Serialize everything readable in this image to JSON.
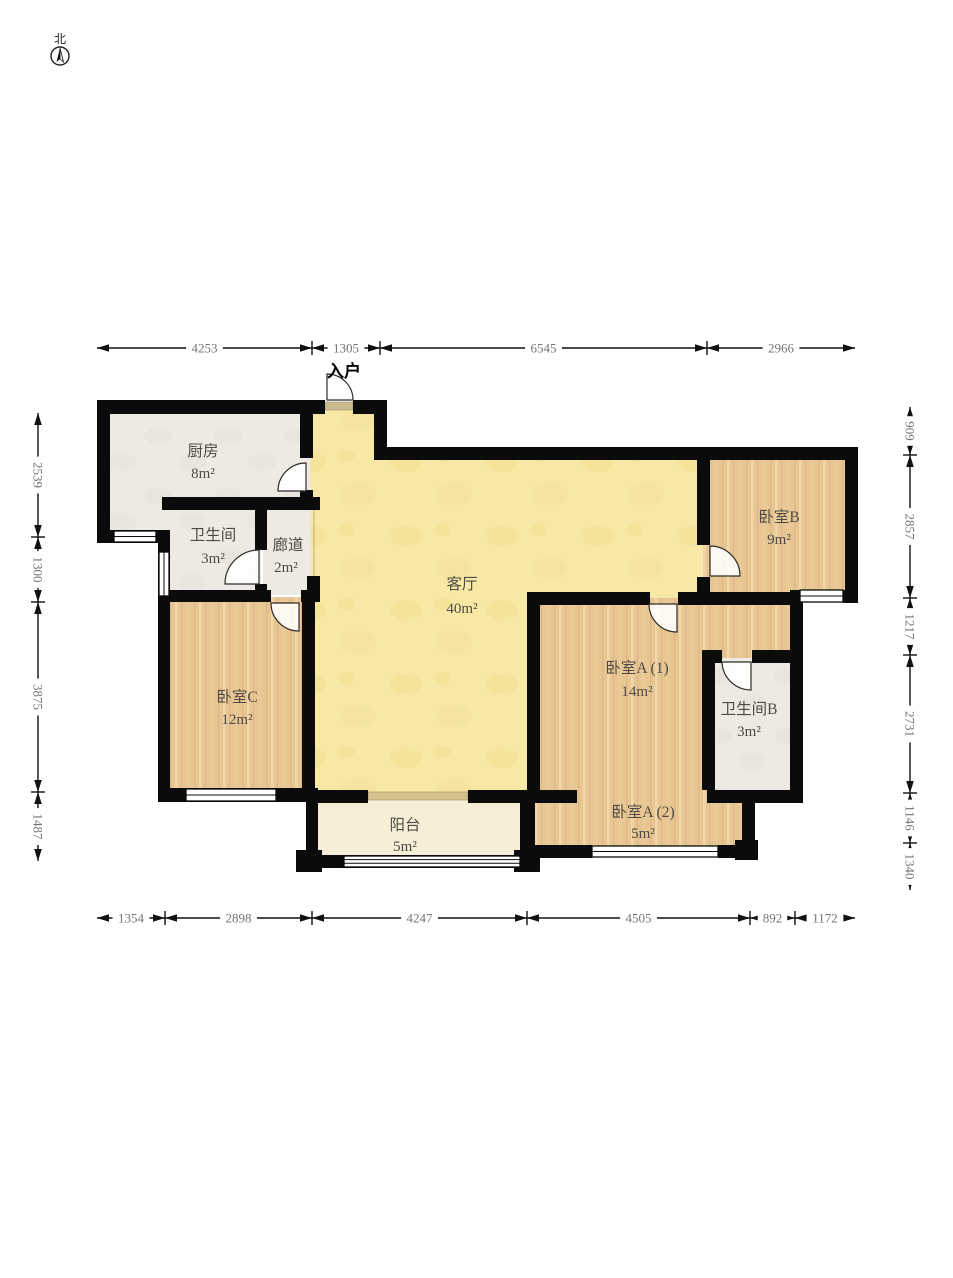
{
  "compass": {
    "label": "北"
  },
  "entrance": {
    "label": "入户"
  },
  "rooms": {
    "kitchen": {
      "name": "厨房",
      "area": "8m²"
    },
    "bathroom_a": {
      "name": "卫生间",
      "area": "3m²"
    },
    "corridor": {
      "name": "廊道",
      "area": "2m²"
    },
    "living": {
      "name": "客厅",
      "area": "40m²"
    },
    "bedroom_b": {
      "name": "卧室B",
      "area": "9m²"
    },
    "bedroom_c": {
      "name": "卧室C",
      "area": "12m²"
    },
    "bedroom_a1": {
      "name": "卧室A (1)",
      "area": "14m²"
    },
    "bathroom_b": {
      "name": "卫生间B",
      "area": "3m²"
    },
    "bedroom_a2": {
      "name": "卧室A (2)",
      "area": "5m²"
    },
    "balcony": {
      "name": "阳台",
      "area": "5m²"
    }
  },
  "dimensions": {
    "top": [
      "4253",
      "1305",
      "6545",
      "2966"
    ],
    "left": [
      "2539",
      "1300",
      "3875",
      "1487"
    ],
    "right": [
      "909",
      "2857",
      "1217",
      "2731",
      "1146",
      "1340"
    ],
    "bottom": [
      "1354",
      "2898",
      "4247",
      "4505",
      "892",
      "1172"
    ]
  },
  "colors": {
    "wall": "#0b0b0b",
    "living": "#f7e8a5",
    "balcony": "#f6eed6",
    "wood": "#e8c694",
    "light_room": "#edeae4",
    "dim_text": "#787470",
    "label_text": "#4f4b44"
  }
}
